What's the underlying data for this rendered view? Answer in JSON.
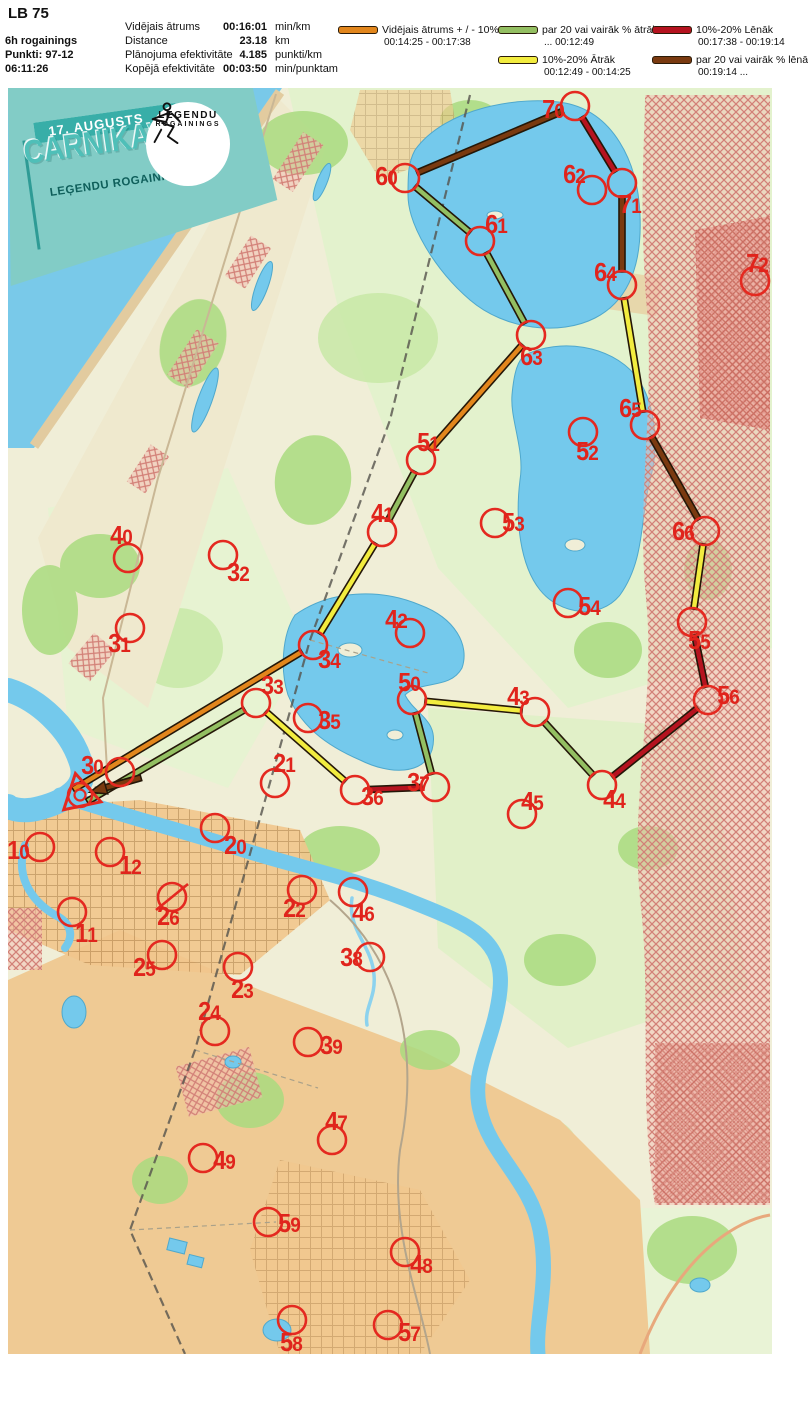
{
  "title": "LB 75",
  "header": {
    "left": {
      "line1": "6h rogainings",
      "line2": "Punkti: 97-12",
      "line3": "06:11:26"
    },
    "stats": [
      {
        "label": "Vidējais ātrums",
        "value": "00:16:01",
        "unit": "min/km"
      },
      {
        "label": "Distance",
        "value": "23.18",
        "unit": "km"
      },
      {
        "label": "Plānojuma efektivitāte",
        "value": "4.185",
        "unit": "punkti/km"
      },
      {
        "label": "Kopējā efektivitāte",
        "value": "00:03:50",
        "unit": "min/punktam"
      }
    ]
  },
  "legend": [
    {
      "pace": "avg",
      "label": "Vidējais ātrums + / - 10%",
      "range": "00:14:25  -  00:17:38"
    },
    {
      "pace": "fast20",
      "label": "par 20 vai vairāk % ātrāk",
      "range": "...  00:12:49"
    },
    {
      "pace": "slow10",
      "label": "10%-20% Lēnāk",
      "range": "00:17:38  - 00:19:14"
    },
    {
      "pace": "fast10",
      "label": "10%-20% Ātrāk",
      "range": "00:12:49  -  00:14:25"
    },
    {
      "pace": "slow20",
      "label": "par 20 vai vairāk % lēnāk",
      "range": "00:19:14  ..."
    }
  ],
  "logo": {
    "date": "17. AUGUSTS",
    "title": "CARNIKAVAS",
    "subtitle": "LEĢENDU ROGAININGS",
    "badge_line1": "LEĢENDU",
    "badge_line2": "ROGAININGS"
  },
  "map": {
    "offset": {
      "x": 8,
      "y": 88
    },
    "start": {
      "x": 80,
      "y": 795
    },
    "pace_colors": {
      "avg": "#E2861C",
      "fast20": "#93BF62",
      "fast10": "#F2EC3F",
      "slow10": "#B5131F",
      "slow20": "#7A3A10"
    },
    "colors": {
      "control": "#E42920",
      "label": "#E0241C",
      "route_outline": "#241708"
    },
    "controls": [
      {
        "id": "10",
        "x": 40,
        "y": 847,
        "lx": -22,
        "ly": 4
      },
      {
        "id": "11",
        "x": 72,
        "y": 912,
        "lx": 14,
        "ly": 22
      },
      {
        "id": "12",
        "x": 110,
        "y": 852,
        "lx": 20,
        "ly": 14
      },
      {
        "id": "20",
        "x": 215,
        "y": 828,
        "lx": 20,
        "ly": 18
      },
      {
        "id": "21",
        "x": 275,
        "y": 783,
        "lx": 9,
        "ly": -19
      },
      {
        "id": "22",
        "x": 302,
        "y": 890,
        "lx": -8,
        "ly": 19
      },
      {
        "id": "23",
        "x": 238,
        "y": 967,
        "lx": 4,
        "ly": 23
      },
      {
        "id": "24",
        "x": 215,
        "y": 1031,
        "lx": -6,
        "ly": -19
      },
      {
        "id": "25",
        "x": 162,
        "y": 955,
        "lx": -18,
        "ly": 13
      },
      {
        "id": "26",
        "x": 172,
        "y": 897,
        "lx": -4,
        "ly": 20,
        "crossed": true
      },
      {
        "id": "30",
        "x": 120,
        "y": 772,
        "lx": -28,
        "ly": -6
      },
      {
        "id": "31",
        "x": 130,
        "y": 628,
        "lx": -11,
        "ly": 16
      },
      {
        "id": "32",
        "x": 223,
        "y": 555,
        "lx": 15,
        "ly": 18
      },
      {
        "id": "33",
        "x": 256,
        "y": 703,
        "lx": 16,
        "ly": -17
      },
      {
        "id": "34",
        "x": 313,
        "y": 645,
        "lx": 16,
        "ly": 15
      },
      {
        "id": "35",
        "x": 308,
        "y": 718,
        "lx": 21,
        "ly": 3
      },
      {
        "id": "36",
        "x": 355,
        "y": 790,
        "lx": 17,
        "ly": 7
      },
      {
        "id": "37",
        "x": 435,
        "y": 787,
        "lx": -17,
        "ly": -4
      },
      {
        "id": "38",
        "x": 370,
        "y": 957,
        "lx": -19,
        "ly": 1
      },
      {
        "id": "39",
        "x": 308,
        "y": 1042,
        "lx": 23,
        "ly": 4
      },
      {
        "id": "40",
        "x": 128,
        "y": 558,
        "lx": -7,
        "ly": -22
      },
      {
        "id": "41",
        "x": 382,
        "y": 532,
        "lx": 0,
        "ly": -18
      },
      {
        "id": "42",
        "x": 410,
        "y": 633,
        "lx": -14,
        "ly": -13
      },
      {
        "id": "43",
        "x": 535,
        "y": 712,
        "lx": -17,
        "ly": -15
      },
      {
        "id": "44",
        "x": 602,
        "y": 785,
        "lx": 12,
        "ly": 15
      },
      {
        "id": "45",
        "x": 522,
        "y": 814,
        "lx": 10,
        "ly": -12
      },
      {
        "id": "46",
        "x": 353,
        "y": 892,
        "lx": 10,
        "ly": 21
      },
      {
        "id": "47",
        "x": 332,
        "y": 1140,
        "lx": 4,
        "ly": -18
      },
      {
        "id": "48",
        "x": 405,
        "y": 1252,
        "lx": 16,
        "ly": 13
      },
      {
        "id": "49",
        "x": 203,
        "y": 1158,
        "lx": 21,
        "ly": 3
      },
      {
        "id": "50",
        "x": 412,
        "y": 700,
        "lx": -3,
        "ly": -17
      },
      {
        "id": "51",
        "x": 421,
        "y": 460,
        "lx": 7,
        "ly": -17
      },
      {
        "id": "52",
        "x": 583,
        "y": 432,
        "lx": 4,
        "ly": 20
      },
      {
        "id": "53",
        "x": 495,
        "y": 523,
        "lx": 18,
        "ly": 0
      },
      {
        "id": "54",
        "x": 568,
        "y": 603,
        "lx": 21,
        "ly": 4
      },
      {
        "id": "55",
        "x": 692,
        "y": 622,
        "lx": 7,
        "ly": 19
      },
      {
        "id": "56",
        "x": 708,
        "y": 700,
        "lx": 20,
        "ly": -4
      },
      {
        "id": "57",
        "x": 388,
        "y": 1325,
        "lx": 21,
        "ly": 8
      },
      {
        "id": "58",
        "x": 292,
        "y": 1320,
        "lx": -1,
        "ly": 23
      },
      {
        "id": "59",
        "x": 268,
        "y": 1222,
        "lx": 21,
        "ly": 2
      },
      {
        "id": "60",
        "x": 405,
        "y": 178,
        "lx": -19,
        "ly": -1
      },
      {
        "id": "61",
        "x": 480,
        "y": 241,
        "lx": 16,
        "ly": -16
      },
      {
        "id": "62",
        "x": 592,
        "y": 190,
        "lx": -18,
        "ly": -15
      },
      {
        "id": "63",
        "x": 531,
        "y": 335,
        "lx": 0,
        "ly": 22
      },
      {
        "id": "64",
        "x": 622,
        "y": 285,
        "lx": -17,
        "ly": -12
      },
      {
        "id": "65",
        "x": 645,
        "y": 425,
        "lx": -15,
        "ly": -16
      },
      {
        "id": "66",
        "x": 705,
        "y": 531,
        "lx": -22,
        "ly": 1
      },
      {
        "id": "70",
        "x": 575,
        "y": 106,
        "lx": -22,
        "ly": 4
      },
      {
        "id": "71",
        "x": 622,
        "y": 183,
        "lx": 8,
        "ly": 22
      },
      {
        "id": "72",
        "x": 755,
        "y": 281,
        "lx": 2,
        "ly": -17
      }
    ],
    "route": [
      {
        "from": "start",
        "to": "34",
        "pace": "avg",
        "from_xy": [
          74,
          789
        ]
      },
      {
        "from": "34",
        "to": "41",
        "pace": "fast10"
      },
      {
        "from": "41",
        "to": "51",
        "pace": "fast20"
      },
      {
        "from": "51",
        "to": "63",
        "pace": "avg"
      },
      {
        "from": "63",
        "to": "61",
        "pace": "fast20"
      },
      {
        "from": "61",
        "to": "60",
        "pace": "fast20"
      },
      {
        "from": "60",
        "to": "70",
        "pace": "slow20"
      },
      {
        "from": "70",
        "to": "71",
        "pace": "slow10"
      },
      {
        "from": "71",
        "to": "64",
        "pace": "slow20"
      },
      {
        "from": "64",
        "to": "65",
        "pace": "fast10"
      },
      {
        "from": "65",
        "to": "66",
        "pace": "slow20"
      },
      {
        "from": "66",
        "to": "55",
        "pace": "fast10"
      },
      {
        "from": "55",
        "to": "56",
        "pace": "slow10"
      },
      {
        "from": "56",
        "to": "44",
        "pace": "slow10"
      },
      {
        "from": "44",
        "to": "43",
        "pace": "fast20"
      },
      {
        "from": "43",
        "to": "50",
        "pace": "fast10"
      },
      {
        "from": "50",
        "to": "37",
        "pace": "fast20"
      },
      {
        "from": "37",
        "to": "36",
        "pace": "slow10"
      },
      {
        "from": "36",
        "to": "33",
        "pace": "fast10"
      },
      {
        "from": "33",
        "to": "30",
        "pace": "fast20",
        "to_xy": [
          88,
          801
        ]
      },
      {
        "from": "30",
        "to": "finish",
        "pace": "slow20",
        "from_xy": [
          140,
          778
        ],
        "arrow": true
      }
    ]
  }
}
